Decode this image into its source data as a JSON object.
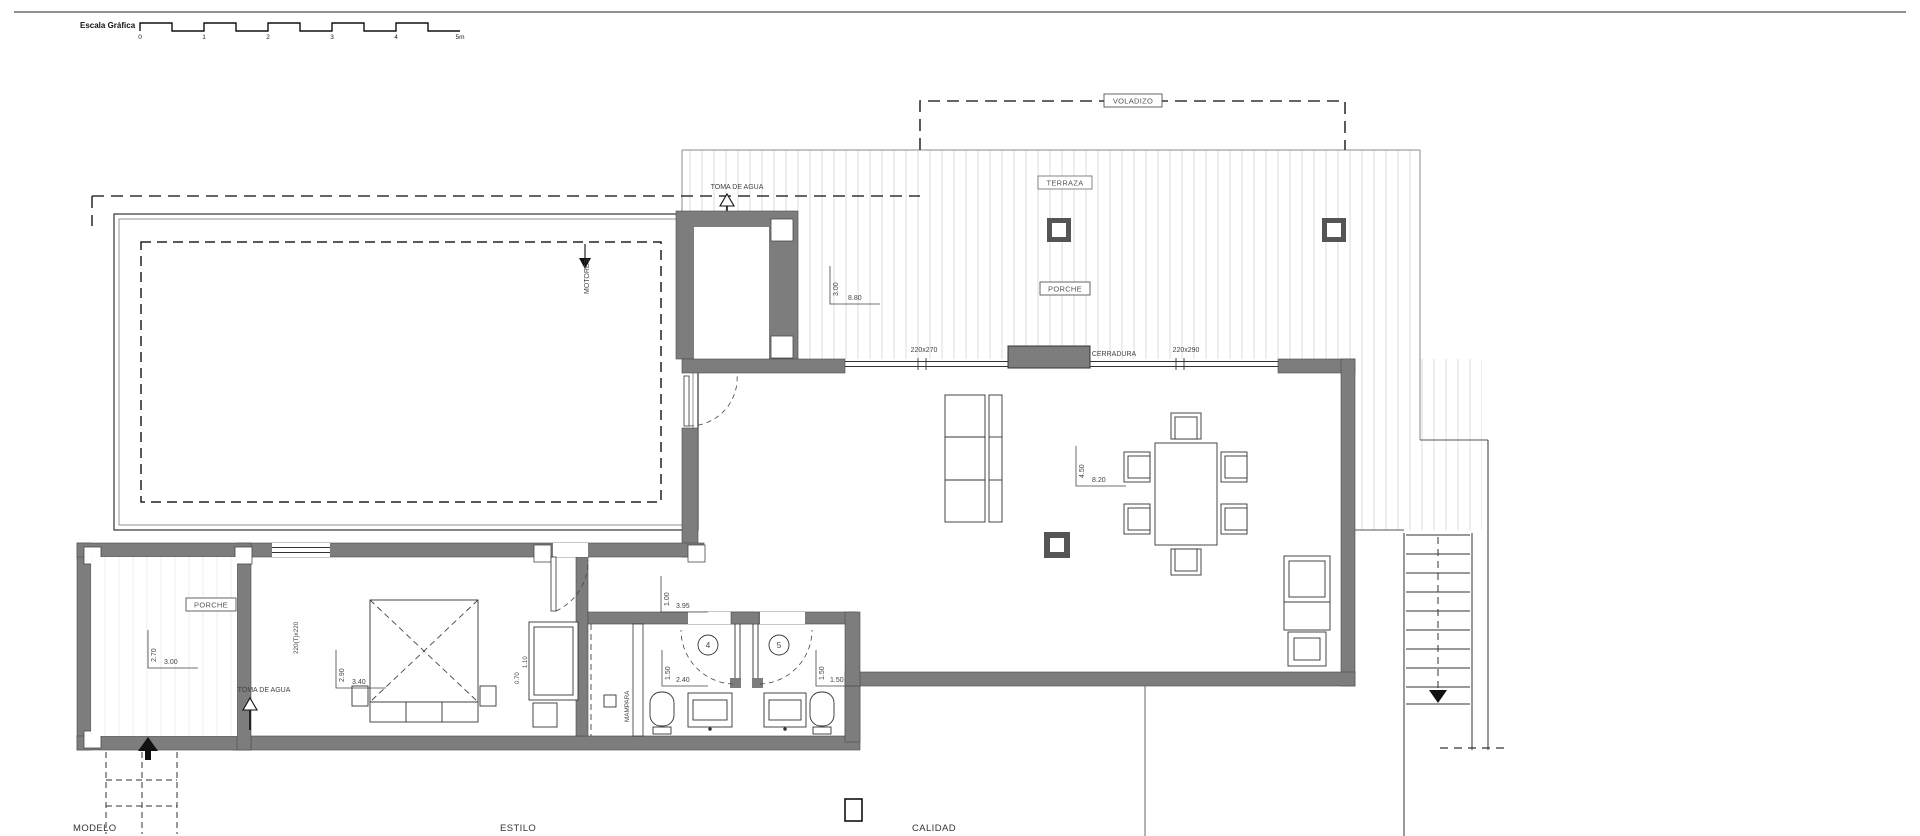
{
  "scale_bar": {
    "title": "Escala Gráfica",
    "ticks": [
      "0",
      "1",
      "2",
      "3",
      "4",
      "5m"
    ]
  },
  "annotations": {
    "voladizo": "VOLADIZO",
    "terraza": "TERRAZA",
    "porche_terraza": "PORCHE",
    "porche_entrada": "PORCHE",
    "cerradura": "CERRADURA",
    "toma_de_agua_piscina": "TOMA DE AGUA",
    "toma_de_agua_porche": "TOMA DE AGUA",
    "motores": "MOTORES",
    "mampara": "MAMPARA",
    "ventana_salon_1": "220x270",
    "ventana_salon_2": "220x290",
    "puerta_dormitorio": "220(T)x220",
    "armario_fondo": "0.70",
    "armario_alto": "1.10",
    "bano_4": "4",
    "bano_5": "5"
  },
  "dimensions": {
    "terraza_ancho": "3.00",
    "terraza_largo": "8.80",
    "salon_ancho": "4.50",
    "salon_largo": "8.20",
    "pasillo_ancho": "1.00",
    "pasillo_largo": "3.95",
    "porche_ancho": "2.70",
    "porche_largo": "3.00",
    "dormitorio_ancho": "2.90",
    "dormitorio_largo": "3.40",
    "bano4_ancho": "1.50",
    "bano4_largo": "2.40",
    "bano5_ancho": "1.50",
    "bano5_largo": "1.50"
  },
  "footer": {
    "modelo": "MODELO",
    "estilo": "ESTILO",
    "calidad": "CALIDAD"
  },
  "colors": {
    "wall": "#7d7d7d",
    "line": "#2a2a2a",
    "deck_stripe": "#dedede"
  }
}
